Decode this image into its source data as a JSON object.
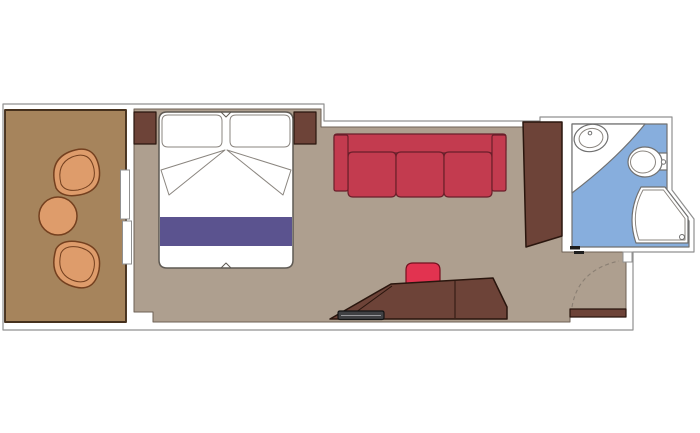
{
  "title": "Cabin floor plan with balcony and bathroom",
  "rooms": {
    "balcony": {
      "name": "balcony",
      "furniture": [
        "chair",
        "round-table",
        "chair"
      ]
    },
    "sleeping_area": {
      "name": "sleeping-area",
      "furniture": [
        "nightstand",
        "double-bed",
        "nightstand"
      ]
    },
    "living_area": {
      "name": "living-area",
      "furniture": [
        "three-seat-sofa",
        "desk",
        "stool",
        "tray",
        "wardrobe"
      ]
    },
    "entry": {
      "name": "entry",
      "furniture": [
        "entrance-door"
      ]
    },
    "bathroom": {
      "name": "bathroom",
      "furniture": [
        "sink",
        "toilet",
        "shower"
      ]
    }
  },
  "colors": {
    "none": "none",
    "wall_fill": "#ffffff",
    "wall_line": "#909090",
    "balcony_floor": "#a6845c",
    "balcony_line": "#46311d",
    "furniture_tan": "#de9c6b",
    "furniture_tan_line": "#74401f",
    "room_floor": "#ae9f8f",
    "room_floor_line": "#6e6156",
    "dark_wood": "#6d4338",
    "dark_wood_line": "#2a160e",
    "white": "#ffffff",
    "fixture_line": "#707070",
    "bed_line": "#5f5a54",
    "pillow_line": "#8a857f",
    "runner_purple": "#5b538f",
    "sofa_red": "#c33b4f",
    "sofa_line": "#6a1f2a",
    "stool_red": "#e23350",
    "stool_line": "#75101f",
    "bath_blue": "#87aedd",
    "tray_gray": "#404144",
    "tray_line": "#141414",
    "tray_highlight": "#97979b",
    "arc_dash": "#8a7f73",
    "track_dark": "#1d1d1d"
  },
  "geometry": {
    "outer_wall": "M3,104 L324,104 L324,121 L540,121 L540,117 L672,117 L672,190 L694,219 L694,252 L633,252 L633,330 L3,330 Z",
    "balcony_floor": "M5,110 H126 V322 H5 Z",
    "room_floor": "M134,109 L321,109 L321,127 L562,127 L562,252 L626,252 L626,317 L570,317 L570,322 L153,322 L153,312 L134,312 Z",
    "bathroom_floor": "M572,124 L667,124 L667,192 L689,221 L689,247 L572,247 Z",
    "bathroom_counter": "M572,124 L645,124 Q618,158 572,193 Z",
    "shower": "M641,187 L665,187 L688,217 L688,243 L636,243 Q626,214 641,187 Z",
    "shower_rim": "M643,190 L663.5,190 L685,218.5 L685,240 L639,240 Q630,214 643,190 Z",
    "shower_drain": "M679.5,237 a2.5,2.5 0 1 0 5,0 a2.5,2.5 0 1 0 -5,0 Z",
    "sink_basin": "M574,138 a17,13.5 0 1 0 34,0 a17,13.5 0 1 0 -34,0 Z",
    "sink_inner": "M579,138 a12,9.5 0 1 0 24,0 a12,9.5 0 1 0 -24,0 Z",
    "sink_faucet": "M589.2,133 a1.8,1.8 0 1 0 3.6,0 a1.8,1.8 0 1 0 -3.6,0 Z",
    "toilet_tank": "M658,153 h9 v17 h-9 Z",
    "toilet_bowl": "M628,162 a17,15 0 1 0 34,0 a17,15 0 1 0 -34,0 Z",
    "toilet_seat": "M630.5,162 a12.5,11 0 1 0 25,0 a12.5,11 0 1 0 -25,0 Z",
    "toilet_flush": "M661.3,162 a2.2,2.2 0 1 0 4.4,0 a2.2,2.2 0 1 0 -4.4,0 Z",
    "wardrobe": "M523,122 L562,122 L562,236 L526,247 Z",
    "chair_top": "M56,188 Q48,161 69,152 Q94,142 99,167 Q103,191 79,195 Q62,198 56,188 Z",
    "chair_top_rim": "M61,184 Q56,164 72,157 Q90,150 94,169 Q97,186 78,190 Q65,192 61,184 Z",
    "chair_bottom": "M56,249 Q48,276 69,285 Q94,295 99,270 Q103,246 79,242 Q62,239 56,249 Z",
    "chair_bottom_rim": "M61,253 Q56,273 72,280 Q90,287 94,268 Q97,251 78,247 Q65,245 61,253 Z",
    "table": "M39,216 a19,19 0 1 0 38,0 a19,19 0 1 0 -38,0 Z",
    "slide_panel_1": "M120.5,170 h9 v49 h-9 Z",
    "slide_panel_2": "M122.5,221 h9 v43 h-9 Z",
    "nightstand_left": "M134,112 h22 v32 h-22 Z",
    "nightstand_right": "M294,112 h22 v32 h-22 Z",
    "bed_body": "M167,112 h118 q8,0 8,8 v140 q0,8 -8,8 h-118 q-8,0 -8,-8 v-140 q0,-8 8,-8 Z",
    "bed_notch_top": "M221,112 L226,117 L231,112",
    "bed_notch_bottom": "M221,268 L226,263 L231,268",
    "pillow_left": "M168,115 h48 q6,0 6,6 v20 q0,6 -6,6 h-48 q-6,0 -6,-6 v-20 q0,-6 6,-6 Z",
    "pillow_right": "M236,115 h48 q6,0 6,6 v20 q0,6 -6,6 h-48 q-6,0 -6,-6 v-20 q0,-6 6,-6 Z",
    "sheet_fold_left": "M225,150 L161,170 L169,195 Z",
    "sheet_fold_right": "M227,150 L291,170 L283,195 Z",
    "bed_runner": "M160,217 h132 v29 h-132 Z",
    "sofa_back": "M337,134 h166 q3,0 3,3 v13 q0,3 -3,3 h-166 q-3,0 -3,-3 v-13 q0,-3 3,-3 Z",
    "sofa_seat_1": "M353,152 h38 q5,0 5,5 v35 q0,5 -5,5 h-38 q-5,0 -5,-5 v-35 q0,-5 5,-5 Z",
    "sofa_seat_2": "M401,152 h38 q5,0 5,5 v35 q0,5 -5,5 h-38 q-5,0 -5,-5 v-35 q0,-5 5,-5 Z",
    "sofa_seat_3": "M449,152 h38 q5,0 5,5 v35 q0,5 -5,5 h-38 q-5,0 -5,-5 v-35 q0,-5 5,-5 Z",
    "sofa_arm_left": "M336,135 h10 q2,0 2,2 v52 q0,2 -2,2 h-10 q-2,0 -2,-2 v-52 q0,-2 2,-2 Z",
    "sofa_arm_right": "M494,135 h10 q2,0 2,2 v52 q0,2 -2,2 h-10 q-2,0 -2,-2 v-52 q0,-2 2,-2 Z",
    "stool": "M413,263 h20 q7,0 7,7 v12 q0,7 -7,7 h-20 q-7,0 -7,-7 v-12 q0,-7 7,-7 Z",
    "desk": "M330,319 L391,284 L493,278 L507,307 L507,319 Z",
    "desk_fold": "M348,318 L392,286",
    "desk_divider": "M455,280 L455,318",
    "tray": "M340,311 h42 q2,0 2,2 v4.5 q0,2 -2,2 h-42 q-2,0 -2,-2 v-4.5 q0,-2 2,-2 Z",
    "tray_highlight": "M341,315.5 h40",
    "door_leaf": "M570,309 h56 v8 h-56 Z",
    "door_arc": "M572,307 Q578,270 619,261",
    "door_jamb": "M623,252 h9 v10 h-9 Z",
    "bath_track_1": "M570,246 h10 v3.5 h-10 Z",
    "bath_track_2": "M574,251 h10 v3 h-10 Z"
  }
}
